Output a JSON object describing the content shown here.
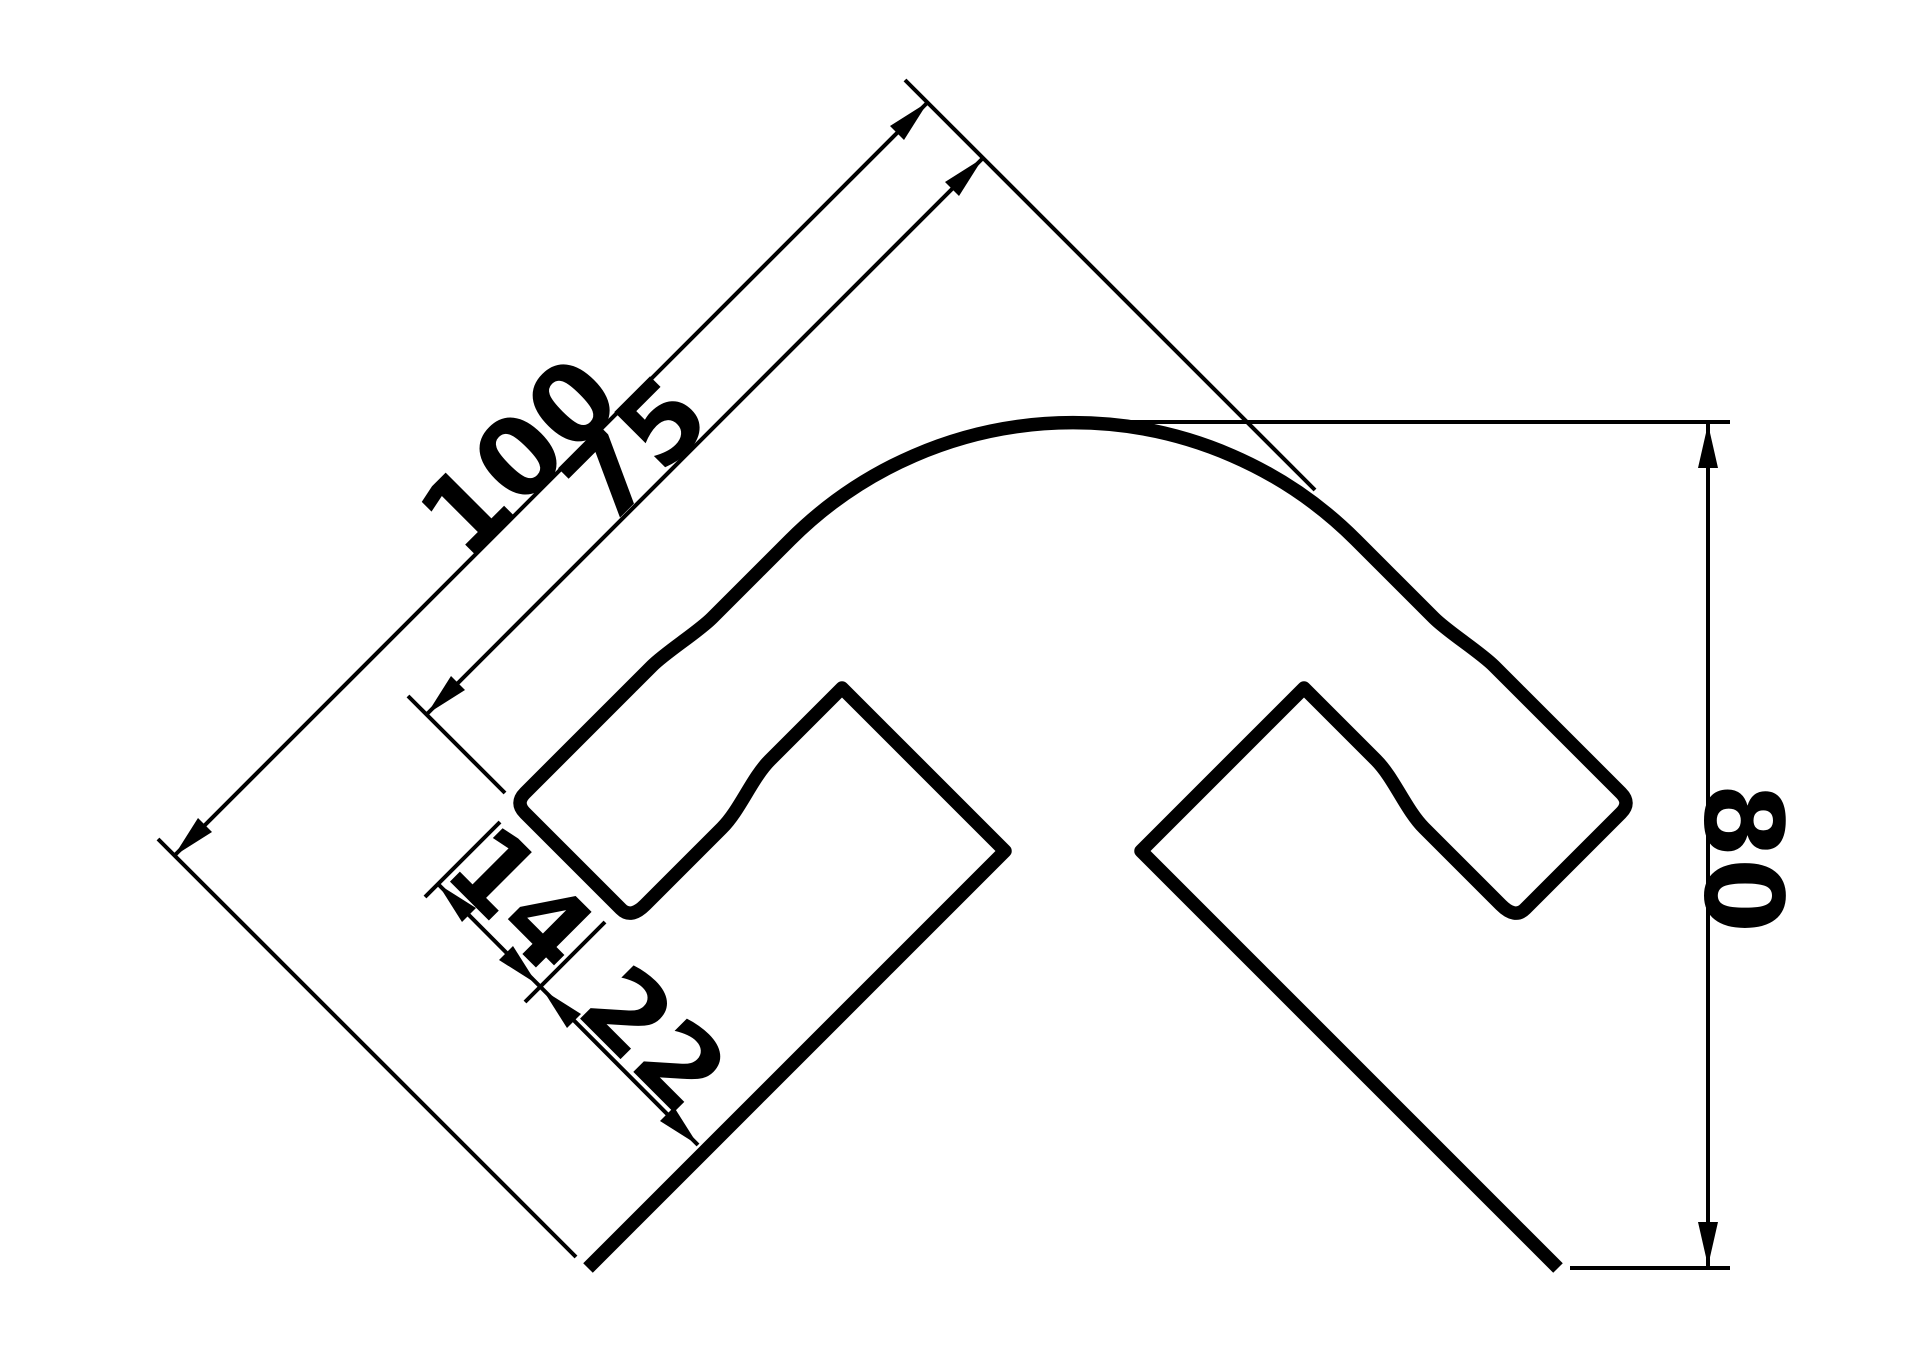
{
  "page": {
    "background_color": "#ffffff",
    "line_color": "#000000",
    "content_type": "technical drawing - corner profile cross-section"
  },
  "drawing": {
    "labels": {
      "outer_leg_length": "100",
      "inner_flange_length": "75",
      "flange_thickness": "14",
      "slot_gap": "22",
      "overall_height": "80"
    }
  }
}
